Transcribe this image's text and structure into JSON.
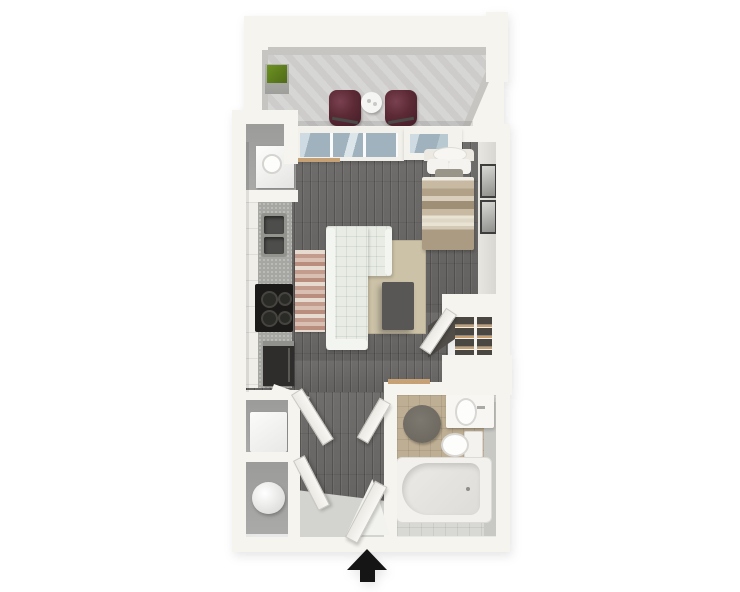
{
  "type": "floorplan",
  "view": "3d-top-down-render",
  "background": "#ffffff",
  "entrance_marker": {
    "icon": "arrow-up-icon",
    "color": "#151515",
    "position": "bottom-center"
  },
  "rooms": [
    {
      "name": "balcony",
      "floor": "concrete",
      "furniture": [
        "patio-chair",
        "patio-chair",
        "round-side-table",
        "planter-box"
      ]
    },
    {
      "name": "living-sleeping-area",
      "floor": "dark-wood",
      "furniture": [
        "sectional-sofa",
        "area-rug",
        "ottoman-coffee-table",
        "runner-rug",
        "bed",
        "wall-art",
        "wall-art",
        "sliding-glass-door",
        "window"
      ]
    },
    {
      "name": "kitchen",
      "floor": "dark-wood",
      "furniture": [
        "cabinet-run",
        "countertop",
        "double-basin-sink",
        "cooktop-stove",
        "refrigerator"
      ]
    },
    {
      "name": "bathroom",
      "floor": "tile",
      "furniture": [
        "vanity-sink",
        "toilet",
        "bathtub",
        "round-bath-rug"
      ]
    },
    {
      "name": "entry-hall",
      "floor": "wood-and-gray",
      "furniture": [
        "entry-door",
        "closet-door",
        "closet-door",
        "bathroom-door"
      ]
    },
    {
      "name": "closets",
      "furniture": [
        "water-heater",
        "washer-unit",
        "shelf-wardrobe",
        "utility-appliance"
      ]
    }
  ],
  "colors": {
    "wall": "#f6f4ee",
    "wallface": "#c6c5c1",
    "concrete": "#d4d3d1",
    "wood": "#6a6866",
    "closetfloor": "#aaaaa8",
    "counter": "#a6a6a2",
    "cabinet": "#efeee9",
    "stove": "#1b1a18",
    "appliance": "#2e2d2b",
    "couch": "#e9ece5",
    "couchtrim": "#f3f6f0",
    "rug": "#ccc2a8",
    "coffeetable": "#595755",
    "runnerlight": "#e7dacf",
    "runnerdark": "#c49c8e",
    "bed1": "#c8b9a2",
    "bed2": "#b1a189",
    "bed3": "#a08f77",
    "bed4": "#ab9b83",
    "pillow": "#f4f3ef",
    "chair": "#5c2a35",
    "plantergreen": "#6e9222",
    "planterpot": "#b3b3af",
    "tiletan": "#beae93",
    "tilelight": "#d8d8d4",
    "bathrug": "#6e6961",
    "entryfloor": "#d3d3cf",
    "glassdark": "#9fb2bd",
    "glasslight": "#cfdbe2",
    "woodcap": "#c6a176",
    "framedark": "#3e3e3c",
    "arrow": "#151515"
  }
}
